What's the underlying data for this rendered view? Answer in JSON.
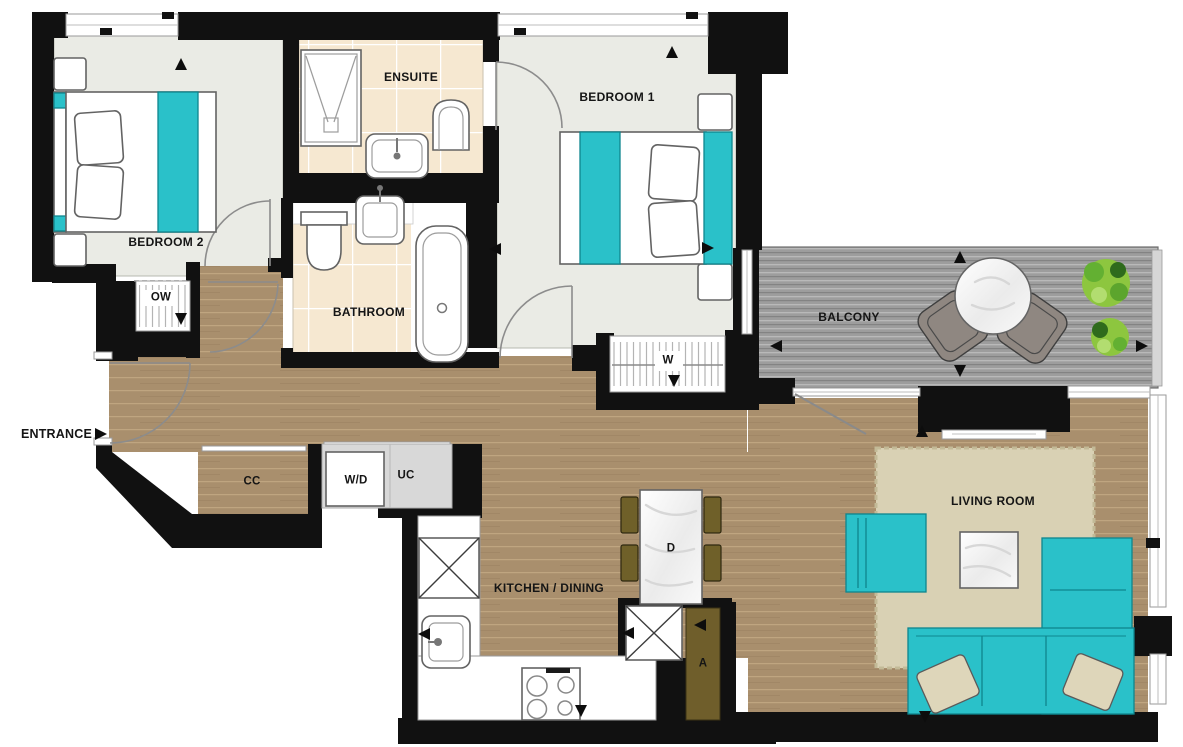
{
  "plan": {
    "rooms": {
      "bedroom2": "BEDROOM 2",
      "ensuite": "ENSUITE",
      "bedroom1": "BEDROOM 1",
      "bathroom": "BATHROOM",
      "balcony": "BALCONY",
      "living_room": "LIVING ROOM",
      "kitchen_dining": "KITCHEN / DINING",
      "entrance": "ENTRANCE"
    },
    "fixtures": {
      "open_wardrobe": "OW",
      "wardrobe": "W",
      "coat_closet": "CC",
      "washer_dryer": "W/D",
      "utility_cupboard": "UC",
      "dining_table": "D",
      "access_panel": "A"
    },
    "colors": {
      "wall": "#111111",
      "teal": "#2ac1c9",
      "wood": "#a98f6d",
      "wood-line": "#c4aa85",
      "tile": "#f6e8d1",
      "deck": "#9d9d9d",
      "rug": "#d9d1b4",
      "bedroom-floor": "#eaebe5",
      "unit-gray": "#d8d8d8",
      "door-brown": "#6f5e2b",
      "chair-olive": "#6f6029",
      "plant-green": "#8dc63f"
    }
  }
}
